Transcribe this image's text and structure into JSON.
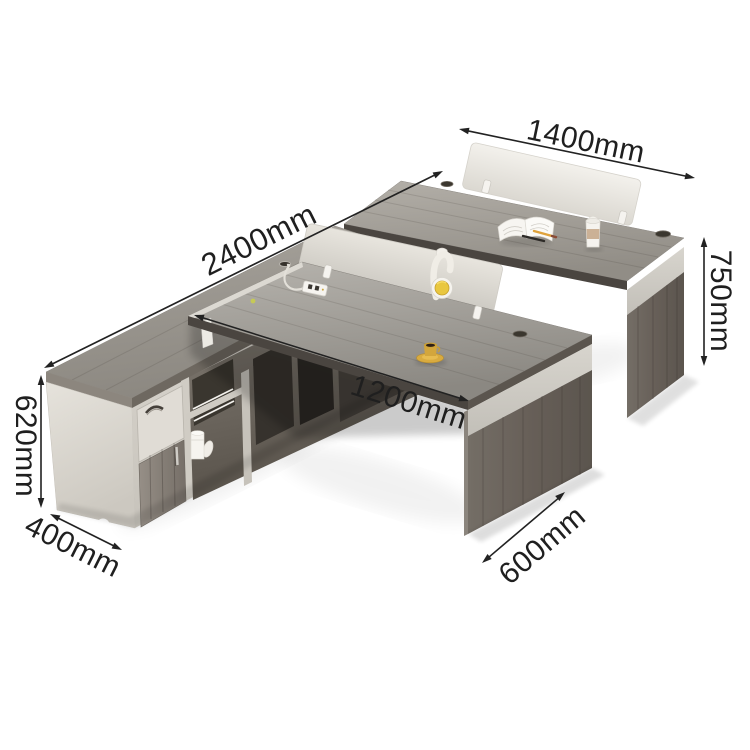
{
  "meta": {
    "type": "product-dimension-diagram",
    "subject": "Two-person staff office desk workstation with privacy screens and side storage cabinet",
    "background": "#ffffff"
  },
  "dimensions": {
    "unit_suffix": "mm",
    "back_desk_width": {
      "label": "1400mm",
      "value": 1400
    },
    "total_length": {
      "label": "2400mm",
      "value": 2400
    },
    "desk_height": {
      "label": "750mm",
      "value": 750
    },
    "front_desk_width": {
      "label": "1200mm",
      "value": 1200
    },
    "cabinet_height": {
      "label": "620mm",
      "value": 620
    },
    "cabinet_depth": {
      "label": "400mm",
      "value": 400
    },
    "desk_depth": {
      "label": "600mm",
      "value": 600
    }
  },
  "colors": {
    "desk_top_wood": "#a19e98",
    "leg_dark_wood": "#675f58",
    "privacy_panel": "#e8e5de",
    "cabinet_body": "#d2cec7",
    "accent_yellow": "#e9c73f",
    "dimension_ink": "#1f1f1f"
  },
  "scene": {
    "items": [
      "back-desk",
      "front-desk",
      "side-cabinet",
      "privacy-screen-back",
      "privacy-screen-front",
      "open-book",
      "pen",
      "pencil",
      "latte-cup",
      "espresso-cup-and-saucer",
      "headphones",
      "power-strip",
      "cable-grommet",
      "shelf-books",
      "storage-boxes",
      "white-mug"
    ]
  }
}
